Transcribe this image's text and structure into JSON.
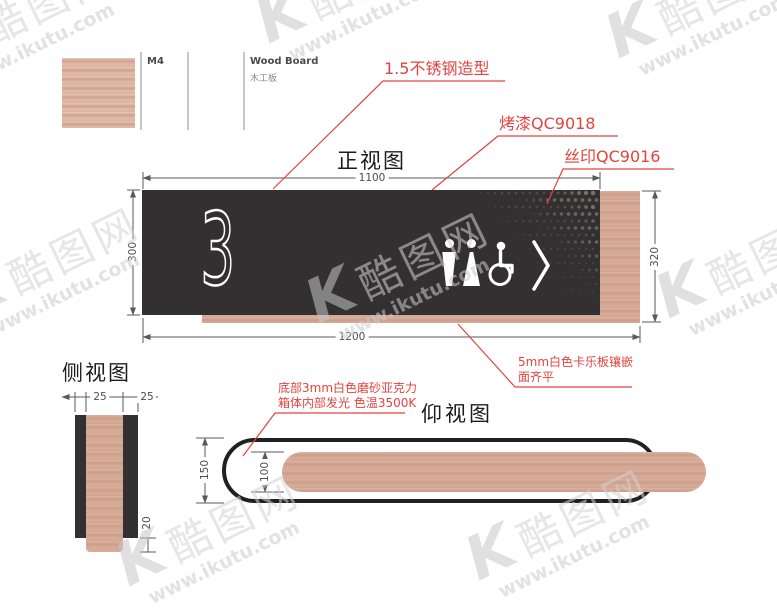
{
  "colors": {
    "red": "#e2433e",
    "panel": "#323031",
    "wood": "#d3a692",
    "line": "#595a5c",
    "watermark": "#cccccc"
  },
  "material_legend": {
    "code": "M4",
    "name_en": "Wood Board",
    "name_cn": "木工板"
  },
  "callouts": {
    "steel": "1.5不锈钢造型",
    "paint": "烤漆QC9018",
    "silkscreen": "丝印QC9016",
    "kaleboard": {
      "line1": "5mm白色卡乐板镶嵌",
      "line2": "面齐平"
    },
    "acrylic": {
      "line1": "底部3mm白色磨砂亚克力",
      "line2": "箱体内部发光 色温3500K"
    }
  },
  "views": {
    "front": {
      "title": "正视图",
      "sign_number": "3",
      "dims": {
        "panel_width": "1100",
        "panel_height": "300",
        "board_height": "320",
        "total_width": "1200"
      },
      "icons": [
        "male-icon",
        "female-icon",
        "wheelchair-icon",
        "chevron-right-icon"
      ]
    },
    "side": {
      "title": "侧视图",
      "dims": {
        "left": "25",
        "right": "25",
        "bottom": "20"
      }
    },
    "bottom": {
      "title": "仰视图",
      "dims": {
        "outer": "150",
        "inner": "100"
      }
    }
  },
  "watermark": {
    "logo": "K",
    "brand": "酷图网",
    "url": "www.ikutu.com"
  },
  "halftone_dots": {
    "cols": 26,
    "rows": 16,
    "spacing": 7
  }
}
